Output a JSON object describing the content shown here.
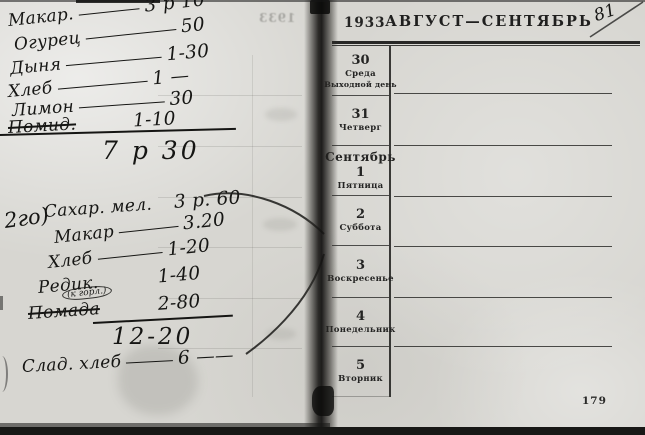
{
  "right_page": {
    "year": "1933",
    "title": "АВГУСТ—СЕНТЯБРЬ",
    "page_number": "179",
    "corner_note": "81",
    "days": [
      {
        "month": "",
        "number": "30",
        "weekday": "Среда",
        "note": "Выходной день"
      },
      {
        "month": "",
        "number": "31",
        "weekday": "Четверг",
        "note": ""
      },
      {
        "month": "Сентябрь",
        "number": "1",
        "weekday": "Пятница",
        "note": ""
      },
      {
        "month": "",
        "number": "2",
        "weekday": "Суббота",
        "note": ""
      },
      {
        "month": "",
        "number": "3",
        "weekday": "Воскресенье",
        "note": ""
      },
      {
        "month": "",
        "number": "4",
        "weekday": "Понедельник",
        "note": ""
      },
      {
        "month": "",
        "number": "5",
        "weekday": "Вторник",
        "note": ""
      }
    ]
  },
  "left_page": {
    "list1": {
      "items": [
        {
          "name": "Макар.",
          "price": "3 р 10"
        },
        {
          "name": "Огурец",
          "price": "50"
        },
        {
          "name": "Дыня",
          "price": "1-30"
        },
        {
          "name": "Хлеб",
          "price": "1 —"
        },
        {
          "name": "Лимон",
          "price": "30"
        },
        {
          "name": "Помид.",
          "price": "1-10"
        }
      ],
      "total": "7 р 30"
    },
    "list2": {
      "marker": "2го)",
      "items": [
        {
          "name": "Сахар. мел.",
          "price": "3 р. 60"
        },
        {
          "name": "Макар",
          "price": "3.20"
        },
        {
          "name": "Хлеб",
          "price": "1-20"
        },
        {
          "name": "Редик.",
          "price": "1-40"
        },
        {
          "name": "Помада",
          "price": "2-80"
        }
      ],
      "insert_note": "(к горл.)",
      "total": "12-20"
    },
    "bottom_line": {
      "name": "Слад. хлеб",
      "price": "6 ——"
    },
    "ghost_year": "1933"
  }
}
